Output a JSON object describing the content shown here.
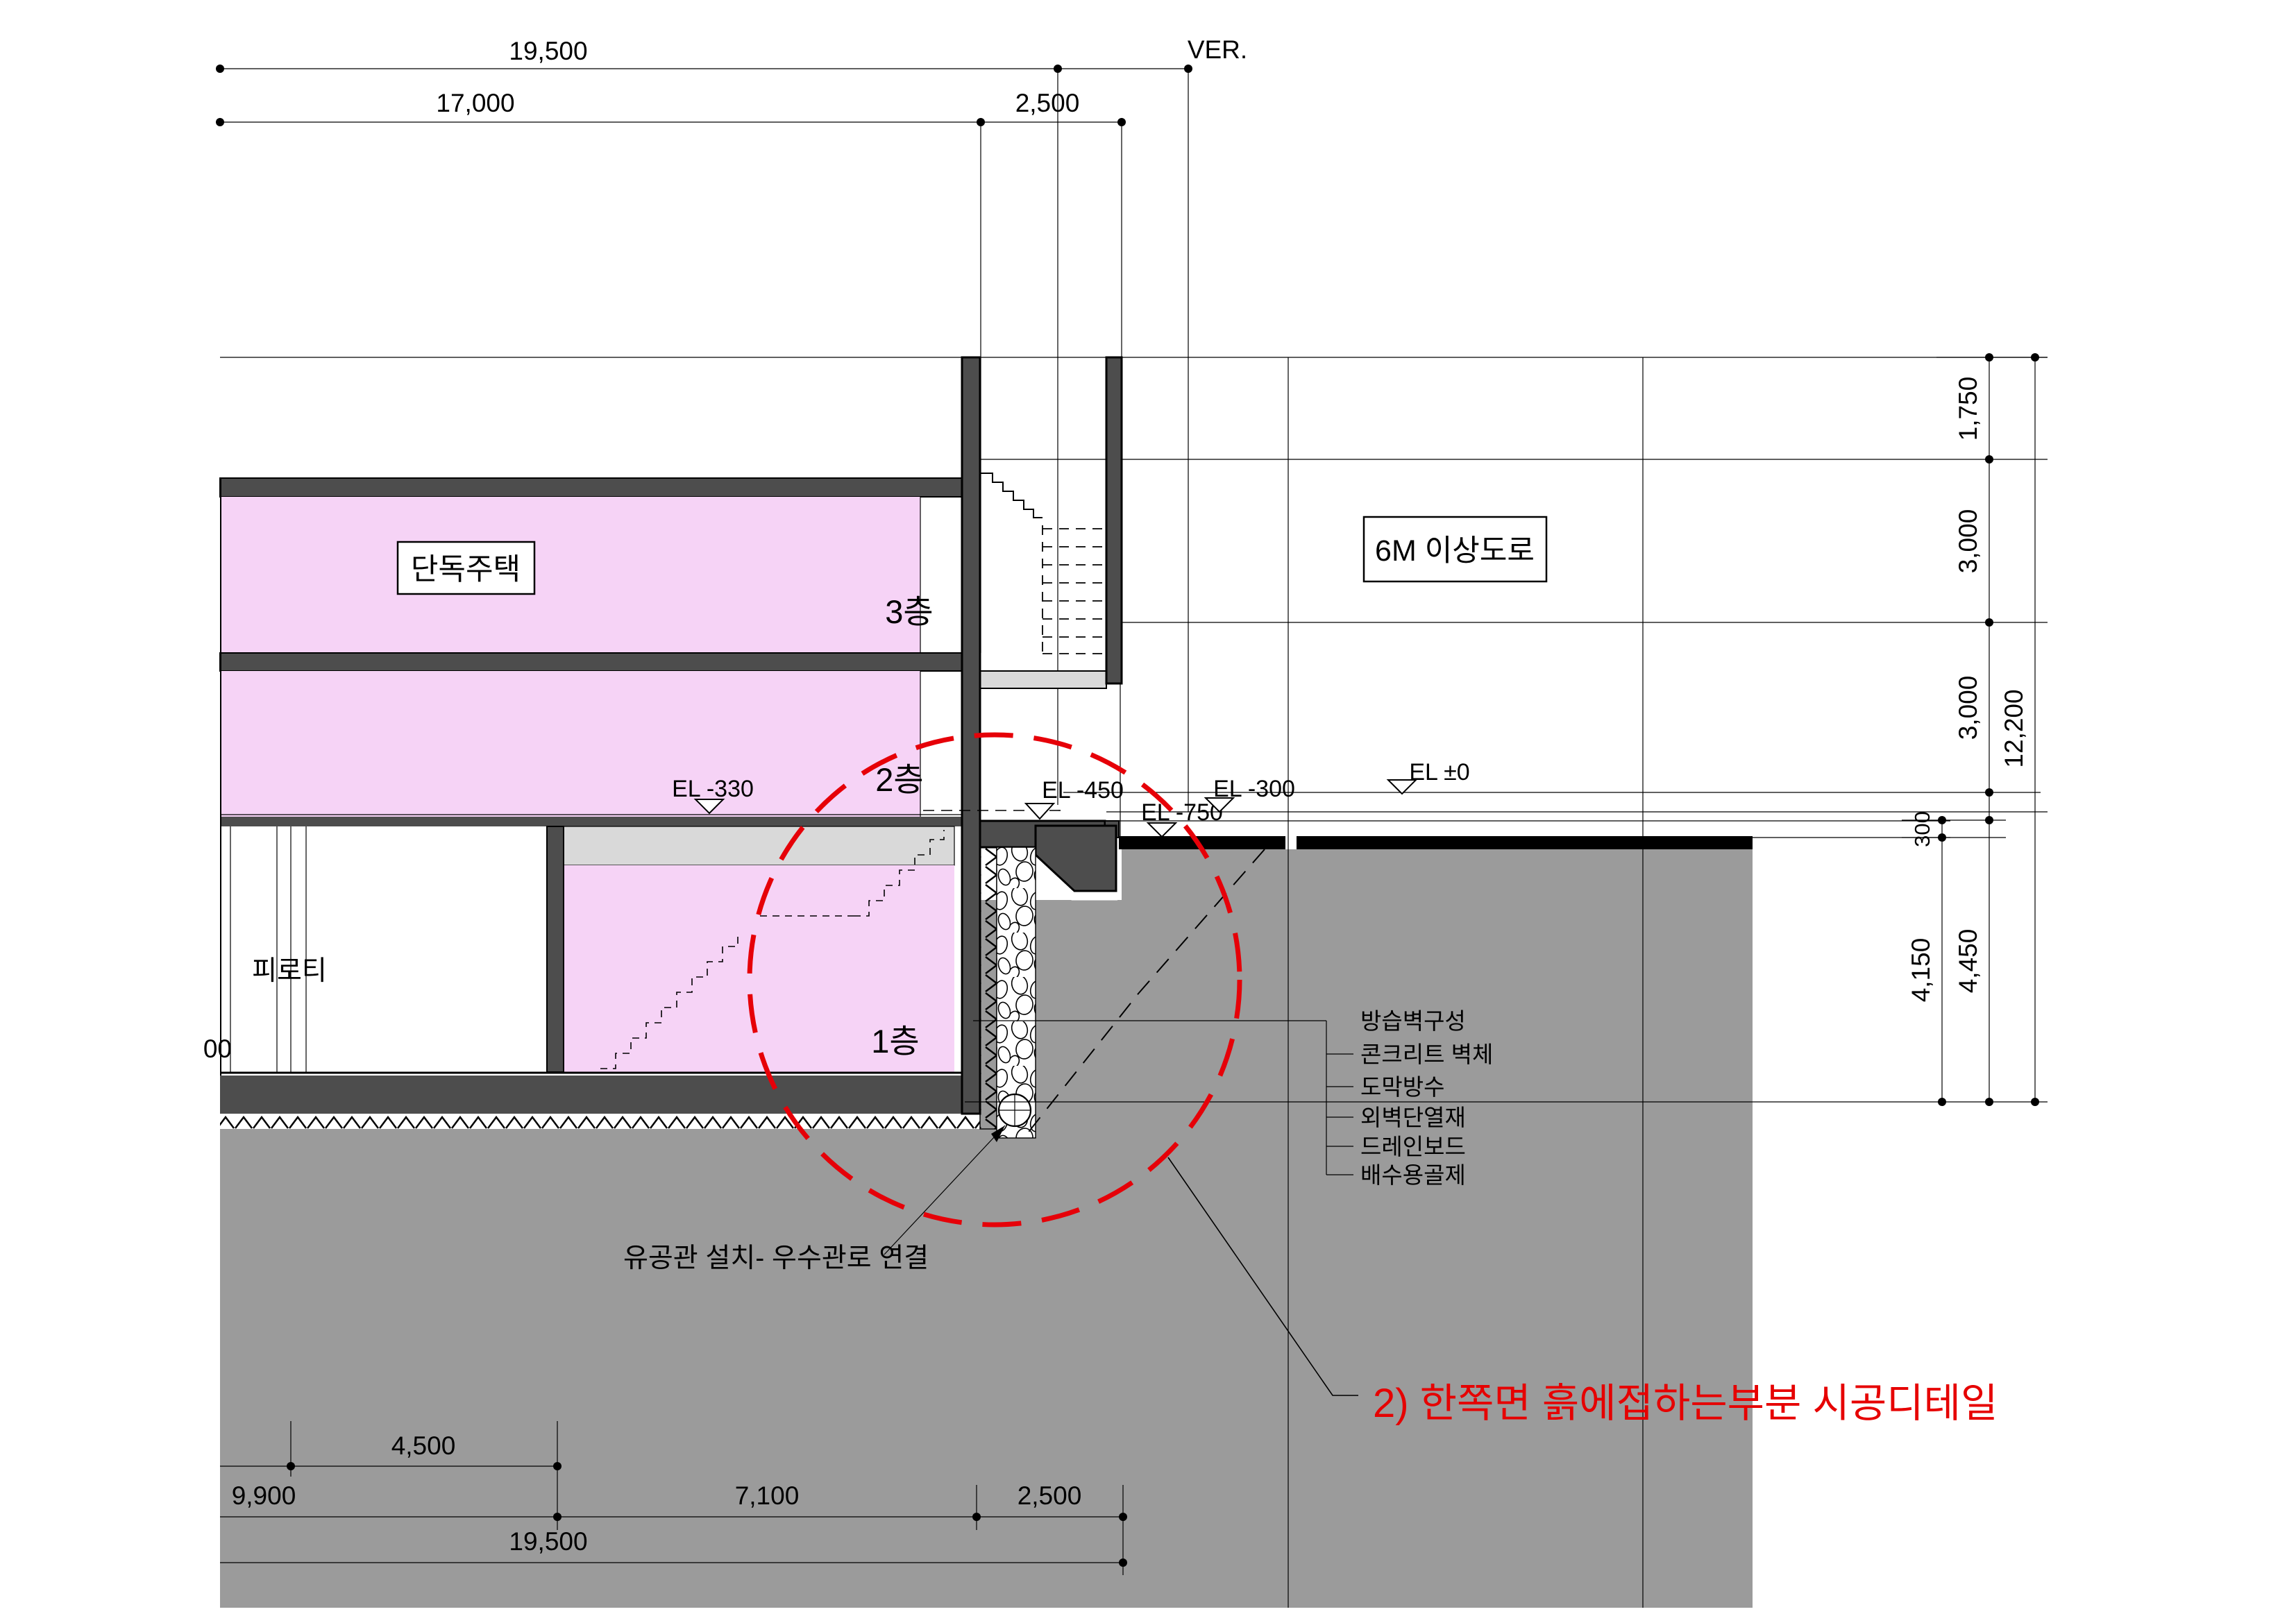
{
  "drawing": {
    "title": "한쪽면 흙에 접하는 부분 시공 단면도",
    "rooms": {
      "house_label": "단독주택",
      "floor3": "3층",
      "floor2": "2층",
      "floor1": "1층",
      "piloti": "피로티",
      "road": "6M 이상도로"
    },
    "levels": {
      "el330": "EL -330",
      "el450": "EL -450",
      "el750": "EL -750",
      "el300": "EL -300",
      "el0": "EL ±0"
    },
    "dims_top": {
      "d19500": "19,500",
      "ver": "VER.",
      "d17000": "17,000",
      "d2500": "2,500"
    },
    "dims_right": {
      "d1750": "1,750",
      "d3000a": "3,000",
      "d3000b": "3,000",
      "d12200": "12,200",
      "d300": "300",
      "d4150": "4,150",
      "d4450": "4,450"
    },
    "dims_bottom": {
      "d4500": "4,500",
      "d9900": "9,900",
      "d7100": "7,100",
      "d2500": "2,500",
      "d19500": "19,500",
      "partial": "00"
    },
    "callouts": [
      "방습벽구성",
      "콘크리트 벽체",
      "도막방수",
      "외벽단열재",
      "드레인보드",
      "배수용골제"
    ],
    "notes": {
      "pipe": "유공관 설치- 우수관로 연결",
      "detail": "2) 한쪽면 흙에접하는부분 시공디테일"
    },
    "colors": {
      "pink": "#f6d3f6",
      "soil": "#9b9b9b",
      "slab": "#4d4d4d",
      "light": "#d9d9d9",
      "red": "#e60000",
      "black": "#000000"
    }
  }
}
